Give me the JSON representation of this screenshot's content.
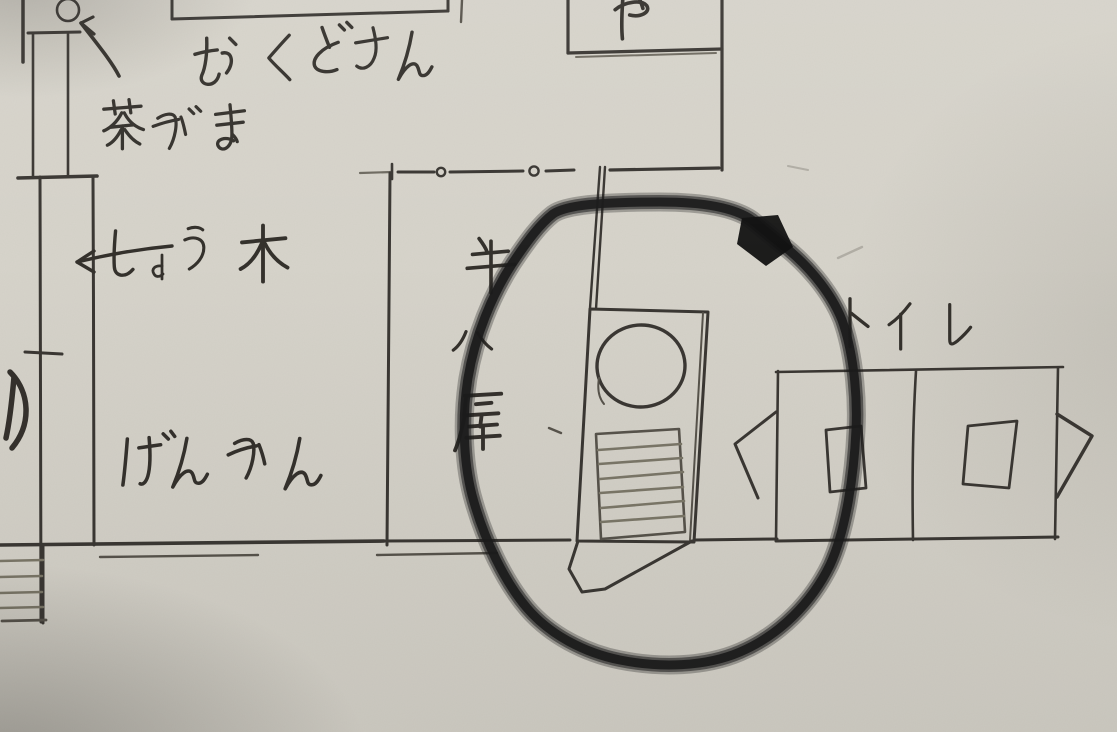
{
  "image": {
    "kind": "photo of a hand-drawn Japanese floor-plan sketch, pen and pencil on paper",
    "language": "ja",
    "paper_color": "#d7d4cb",
    "ink_color": "#3a3733",
    "marker_color": "#1b1b1b"
  },
  "labels": {
    "okudosan": "おくどさん",
    "chagama": "茶がま、",
    "shouki": "しょう木",
    "genkan": "げんかん",
    "ushigoya": "牛小屋",
    "toilet": "トイレ",
    "ya_partial": "や",
    "edge_partial": "り)"
  },
  "annotations": {
    "arrow_to_left": "←",
    "highlight_circle": "thick black marker ring drawn around the bath / boiler unit",
    "dashed_opening": "dashed wall line with two small circles (sliding-door opening) above the cow-shed area"
  },
  "features": {
    "stove_box": "rectangle above the おくどさん label, cut off by the top edge",
    "ya_box": "small room box at top labelled や (cut off)",
    "bath_unit": "tilted rectangle holding a large round opening above a slatted grate, with a chute shape at its base",
    "toilet_block": "two stalls split by a divider, each with a small rectangular squat basin and angled door flaps at both ends",
    "hatched_corner": "slatted strip in the bottom-left corner",
    "small_circle_top_left": "small circle at the top-left wall junction",
    "wall_tick": "short tick crossing the left wall"
  }
}
